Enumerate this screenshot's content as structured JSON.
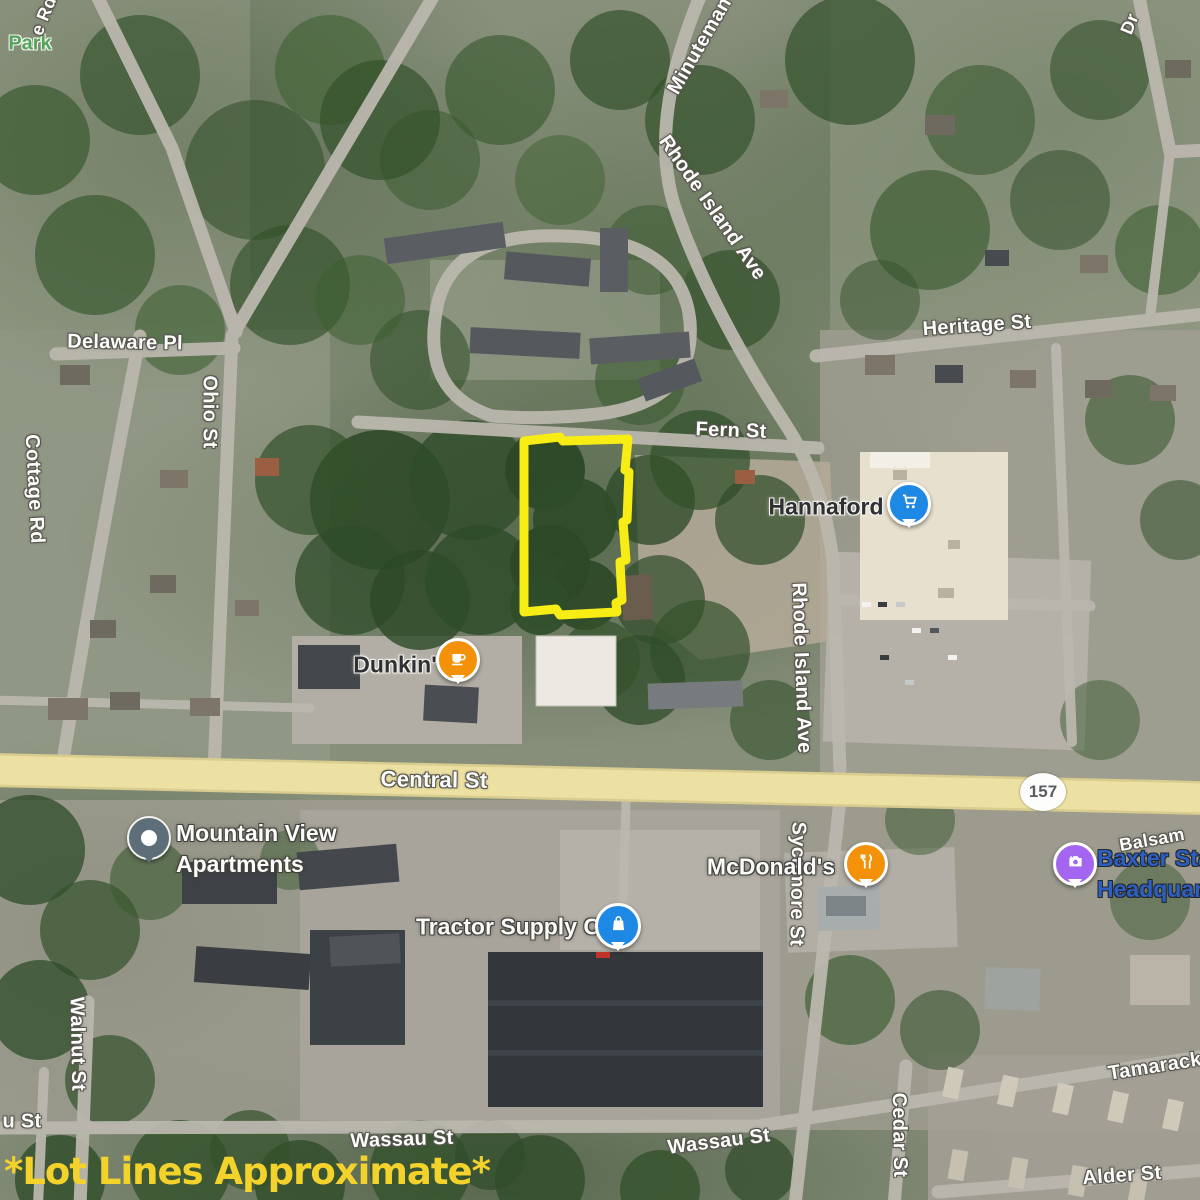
{
  "labels": {
    "park": {
      "text": "Park"
    },
    "e_rd": {
      "text": "e Rd"
    },
    "minuteman": {
      "text": "Minuteman"
    },
    "dr": {
      "text": "Dr"
    },
    "rhode_island_upper": {
      "text": "Rhode Island Ave"
    },
    "heritage_st": {
      "text": "Heritage St"
    },
    "delaware_pl": {
      "text": "Delaware Pl"
    },
    "ohio_st": {
      "text": "Ohio St"
    },
    "cottage_rd": {
      "text": "Cottage Rd"
    },
    "fern_st": {
      "text": "Fern St"
    },
    "rhode_island_lower": {
      "text": "Rhode Island Ave"
    },
    "central_st": {
      "text": "Central St"
    },
    "sycamore_st": {
      "text": "Sycamore St"
    },
    "balsam": {
      "text": "Balsam"
    },
    "walnut_st": {
      "text": "Walnut St"
    },
    "wassau_st_fragment": {
      "text": "u St"
    },
    "wassau_st_center": {
      "text": "Wassau St"
    },
    "wassau_st_right": {
      "text": "Wassau St"
    },
    "tamarack": {
      "text": "Tamarack"
    },
    "cedar_st": {
      "text": "Cedar St"
    },
    "alder_st": {
      "text": "Alder St"
    }
  },
  "route_shield": {
    "text": "157"
  },
  "pois": {
    "hannaford": {
      "label": "Hannaford",
      "icon": "shopping-cart-icon",
      "pin_color": "#1e88e5"
    },
    "dunkin": {
      "label": "Dunkin'",
      "icon": "coffee-cup-icon",
      "pin_color": "#f39208"
    },
    "mountain_view_apartments": {
      "label_line1": "Mountain View",
      "label_line2": "Apartments",
      "icon": "lodging-dot-icon",
      "pin_color": "#5d6e79"
    },
    "mcdonalds": {
      "label": "McDonald's",
      "icon": "fork-knife-icon",
      "pin_color": "#f39208"
    },
    "tractor_supply": {
      "label": "Tractor Supply Co",
      "icon": "shopping-bag-icon",
      "pin_color": "#1e88e5"
    },
    "baxter_state_headquarters": {
      "label_line1": "Baxter Sta",
      "label_line2": "Headquar",
      "icon": "camera-icon",
      "pin_color": "#a466f0"
    }
  },
  "annotation": {
    "disclaimer": "*Lot Lines Approximate*",
    "disclaimer_color": "#f4d22c",
    "lot_line_color": "#f7ec13"
  }
}
